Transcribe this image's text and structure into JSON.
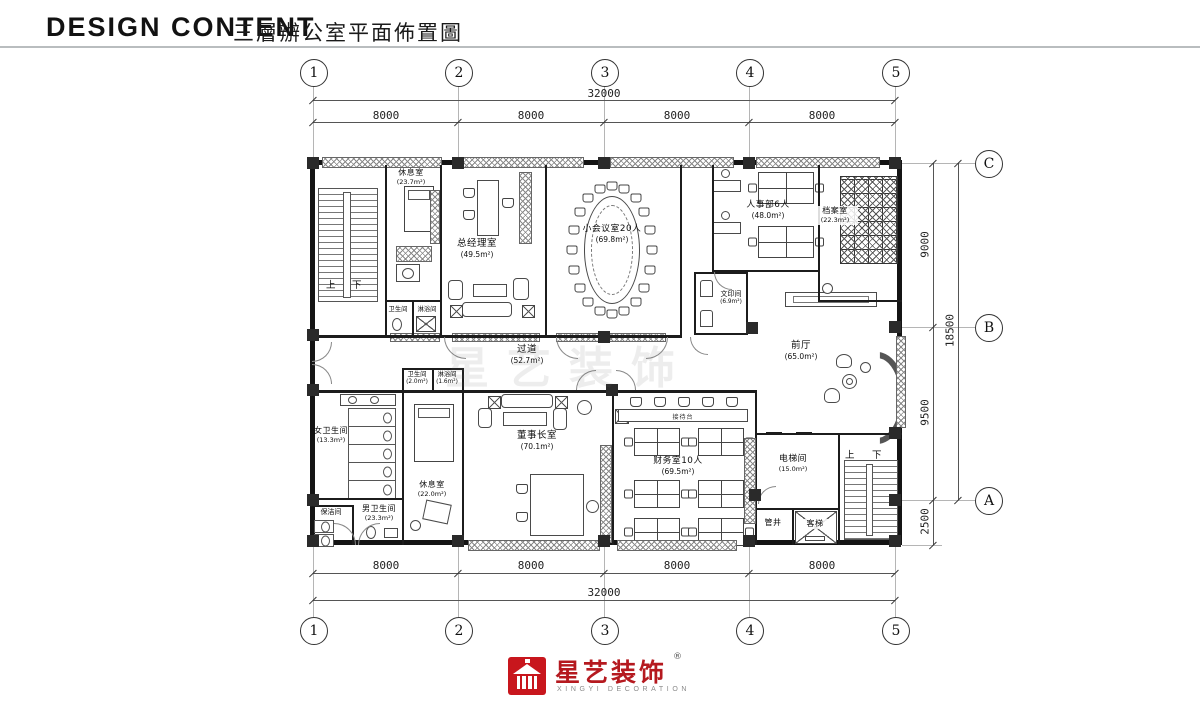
{
  "header": {
    "title_en": "DESIGN CONTENT",
    "title_zh": "三層辦公室平面佈置圖"
  },
  "grid": {
    "cols": [
      "1",
      "2",
      "3",
      "4",
      "5"
    ],
    "rows": [
      "C",
      "B",
      "A"
    ],
    "top": {
      "total": "32000",
      "bays": [
        "8000",
        "8000",
        "8000",
        "8000"
      ]
    },
    "bottom": {
      "total": "32000",
      "bays": [
        "8000",
        "8000",
        "8000",
        "8000"
      ]
    },
    "right": {
      "seg_cb": "9000",
      "seg_ba": "9500",
      "seg_a_edge": "2500",
      "total": "18500"
    }
  },
  "rooms": {
    "rest_top": {
      "name": "休息室",
      "area": "(23.7m²)"
    },
    "wc_top": {
      "name": "卫生间",
      "area": ""
    },
    "shower_top": {
      "name": "淋浴间",
      "area": ""
    },
    "gm": {
      "name": "总经理室",
      "area": "(49.5m²)"
    },
    "meeting": {
      "name": "小会议室20人",
      "area": "(69.8m²)"
    },
    "hr": {
      "name": "人事部6人",
      "area": "(48.0m²)"
    },
    "archive": {
      "name": "档案室",
      "area": "(22.3m²)"
    },
    "print": {
      "name": "文印间",
      "area": "(6.9m²)"
    },
    "corridor": {
      "name": "过道",
      "area": "(52.7m²)"
    },
    "lobby": {
      "name": "前厅",
      "area": "(65.0m²)"
    },
    "wc_small": {
      "name": "卫生间",
      "area": "(2.0m²)"
    },
    "shower_small": {
      "name": "淋浴间",
      "area": "(1.6m²)"
    },
    "women_wc": {
      "name": "女卫生间",
      "area": "(13.3m²)"
    },
    "cleaning": {
      "name": "保洁间",
      "area": ""
    },
    "men_wc": {
      "name": "男卫生间",
      "area": "(23.3m²)"
    },
    "rest_bottom": {
      "name": "休息室",
      "area": "(22.0m²)"
    },
    "chairman": {
      "name": "董事长室",
      "area": "(70.1m²)"
    },
    "finance": {
      "name": "财务室10人",
      "area": "(69.5m²)"
    },
    "reception": {
      "name": "接待台",
      "area": ""
    },
    "elev_hall": {
      "name": "电梯间",
      "area": "(15.0m²)"
    },
    "shaft": {
      "name": "管井",
      "area": ""
    },
    "lift": {
      "name": "客梯",
      "area": ""
    }
  },
  "stair": {
    "up": "上",
    "down": "下"
  },
  "watermark": "星艺装饰",
  "logo": {
    "zh": "星艺装饰",
    "en": "XINGYI DECORATION",
    "reg": "®"
  },
  "colors": {
    "brand_red": "#c8161d",
    "line": "#1a1a1a"
  }
}
